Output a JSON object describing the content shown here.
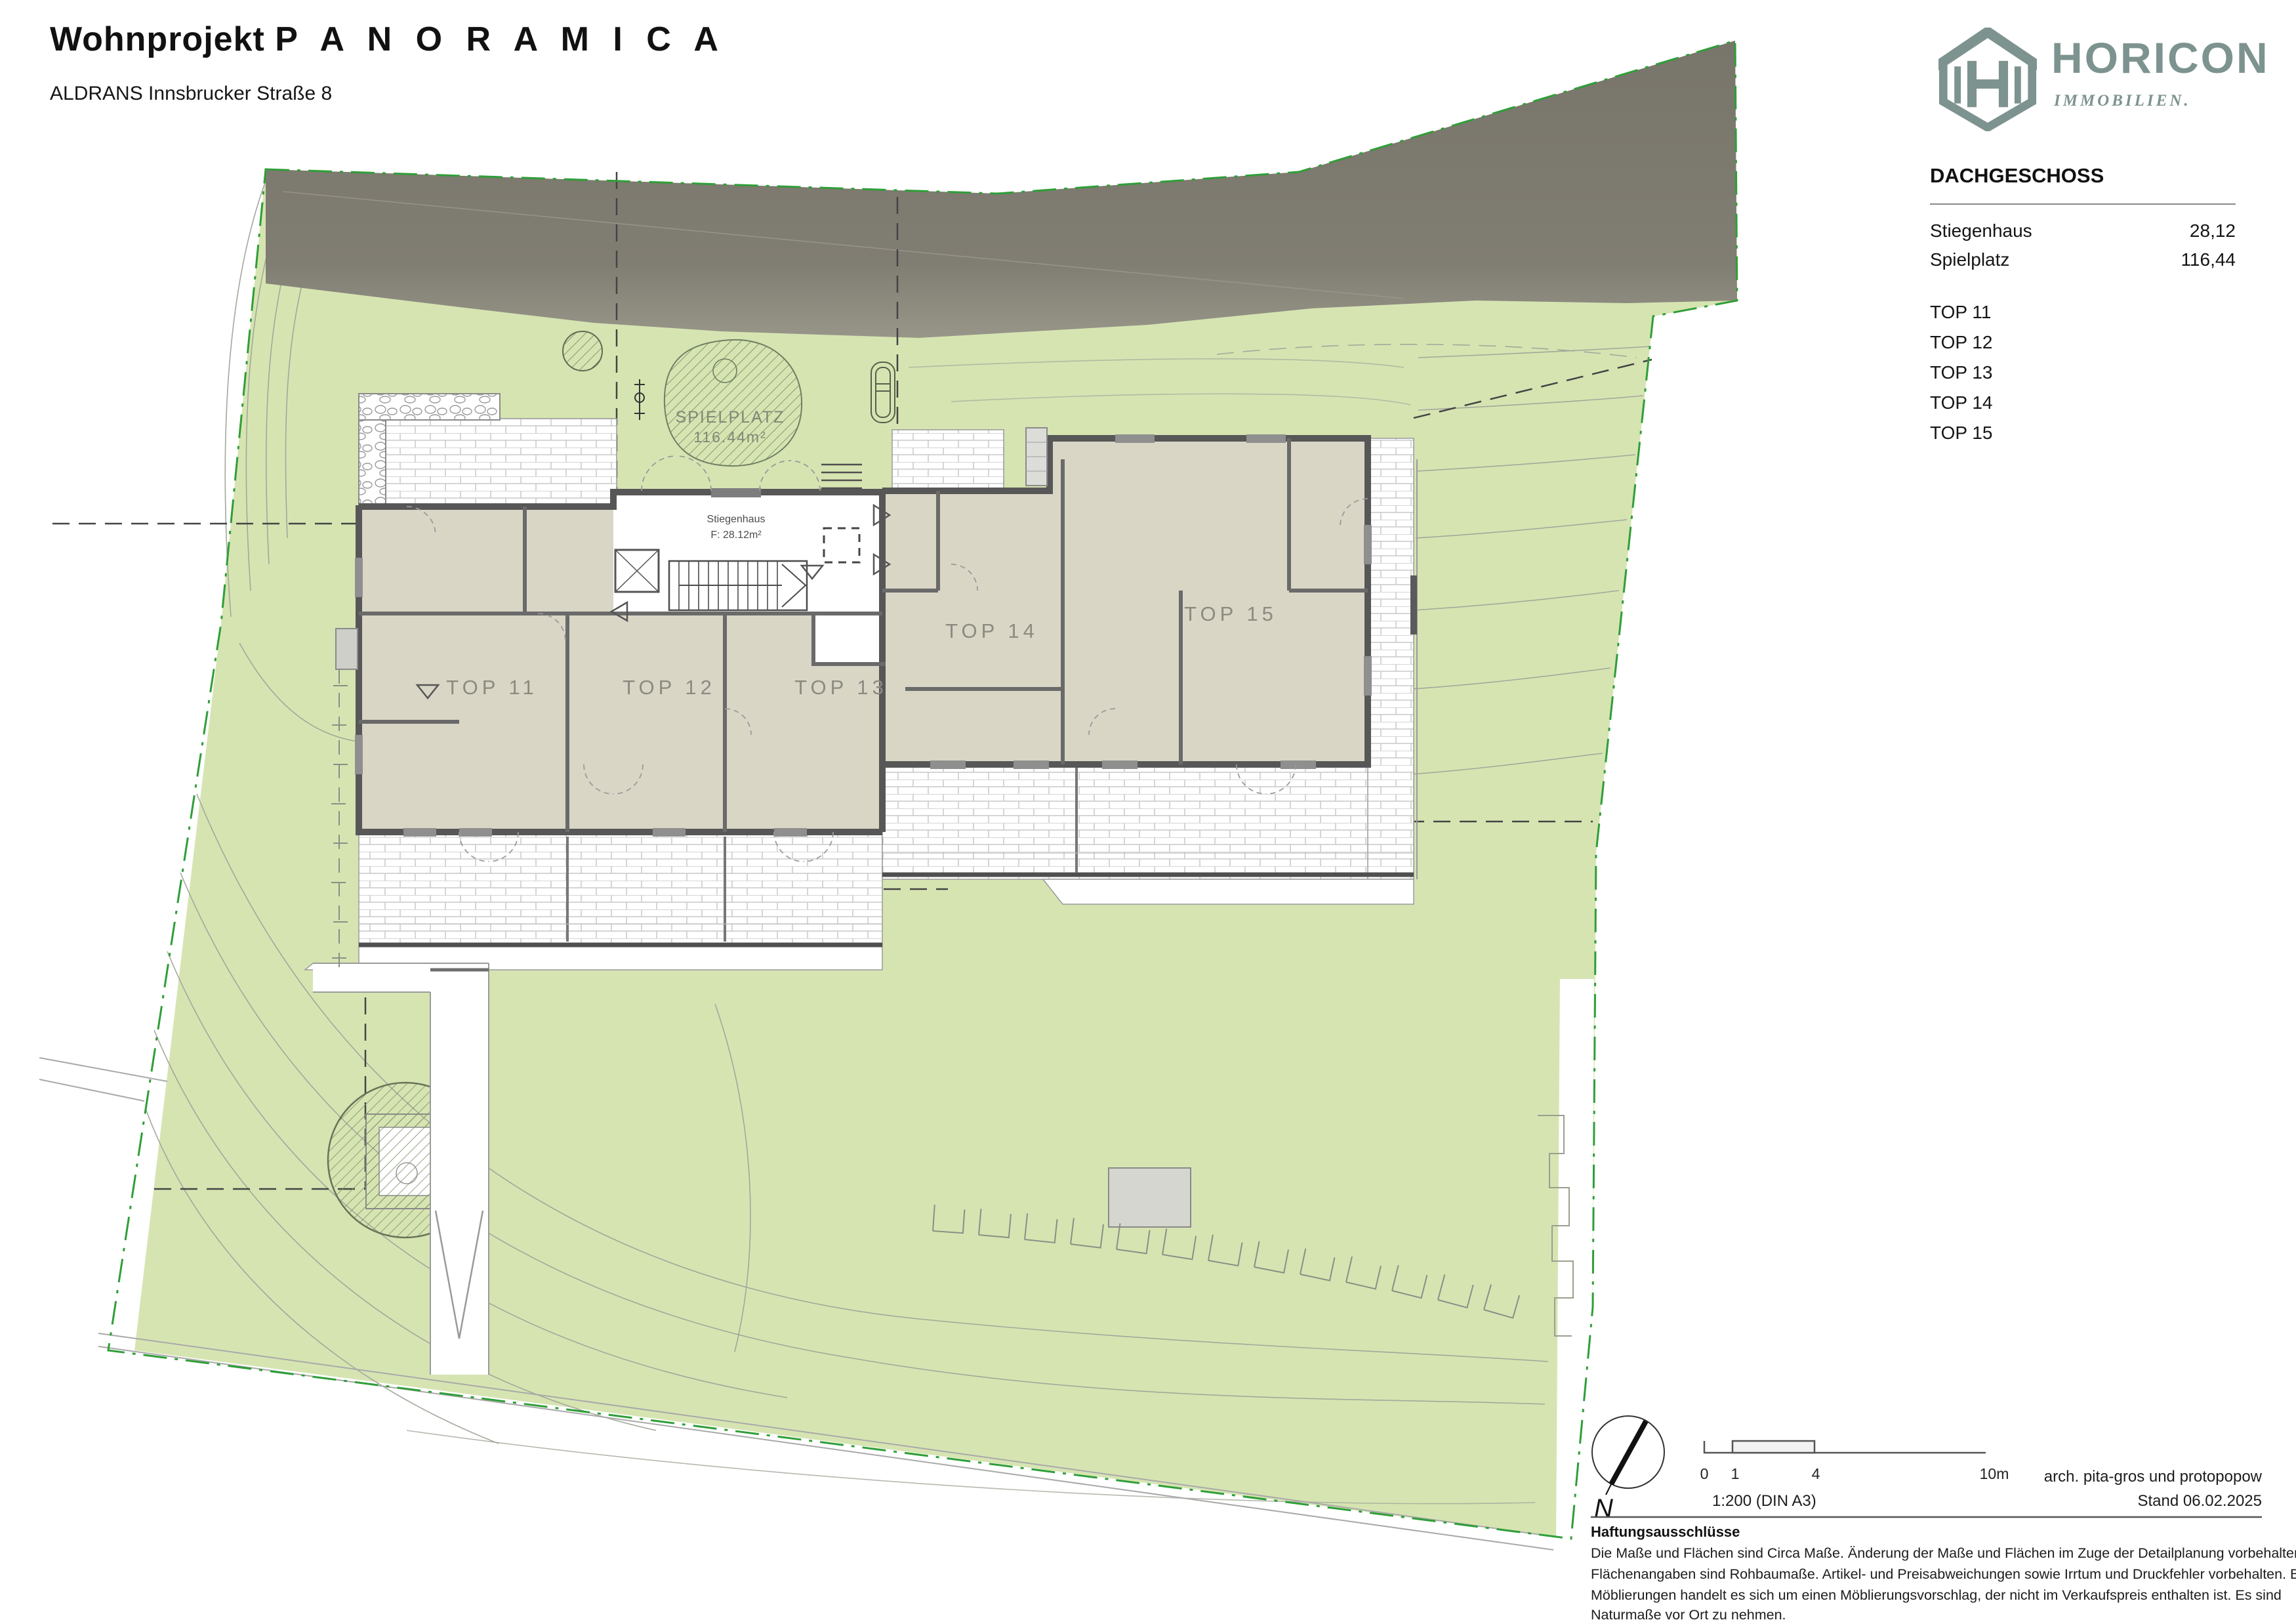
{
  "header": {
    "title_prefix": "Wohnprojekt",
    "title_name": "P A N O R A M I C A",
    "subtitle": "ALDRANS Innsbrucker Straße 8"
  },
  "logo": {
    "brand": "HORICON",
    "tagline": "IMMOBILIEN.",
    "color": "#7d938f"
  },
  "legend": {
    "floor_title": "DACHGESCHOSS",
    "rows": [
      {
        "label": "Stiegenhaus",
        "value": "28,12"
      },
      {
        "label": "Spielplatz",
        "value": "116,44"
      }
    ],
    "tops": [
      "TOP 11",
      "TOP 12",
      "TOP 13",
      "TOP 14",
      "TOP 15"
    ]
  },
  "plan": {
    "apartments": [
      "TOP 11",
      "TOP 12",
      "TOP 13",
      "TOP 14",
      "TOP 15"
    ],
    "spielplatz_label": "SPIELPLATZ",
    "spielplatz_area": "116.44m²",
    "stiegenhaus_label": "Stiegenhaus",
    "stiegenhaus_area": "F:  28.12m²"
  },
  "footer": {
    "north_label": "N",
    "scale_ticks": [
      "0",
      "1",
      "4",
      "10m"
    ],
    "scale_ratio": "1:200 (DIN A3)",
    "architect": "arch. pita-gros und protopopow",
    "date": "Stand 06.02.2025",
    "disclaimer_title": "Haftungsausschlüsse",
    "disclaimer_lines": [
      "Die Maße und Flächen sind Circa Maße. Änderung der Maße und Flächen im Zuge der Detailplanung vorbehalten.",
      "Flächenangaben sind Rohbaumaße. Artikel- und Preisabweichungen sowie Irrtum und Druckfehler vorbehalten. Bei den",
      "Möblierungen handelt es sich um einen Möblierungsvorschlag, der nicht im Verkaufspreis enthalten ist. Es sind",
      "Naturmaße vor Ort zu nehmen."
    ]
  },
  "colors": {
    "site_green": "#d6e4b2",
    "road_grey": "#7b7869",
    "wall_grey": "#575757",
    "room_beige": "#d9d6c6",
    "boundary_green": "#2f9e38",
    "label_grey": "#8b8b80",
    "logo_teal": "#7d938f"
  }
}
